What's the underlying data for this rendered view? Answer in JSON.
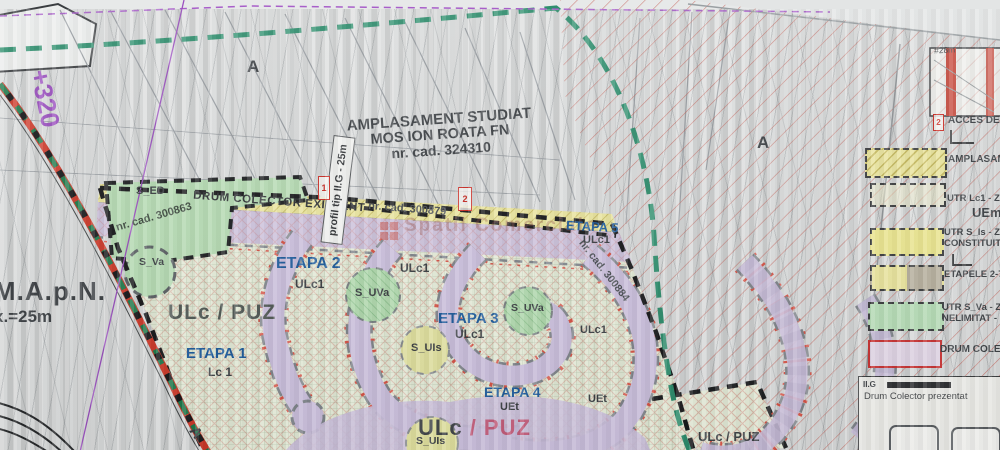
{
  "map": {
    "region_labels": {
      "a1": "A",
      "a2": "A",
      "a3": "A"
    },
    "annotations": {
      "plus320": "+320",
      "mapn": "M.A.p.N.",
      "mapn_width": "x.=25m",
      "amplasament_line1": "AMPLASAMENT STUDIAT",
      "amplasament_line2": "MOS ION ROATA FN",
      "amplasament_line3": "nr. cad. 324310",
      "drum_colector": "DRUM COLECTOR EXISTENT",
      "profil": "profil tip II.G - 25m",
      "cad_300863": "nr. cad. 300863",
      "cad_300879": "nr. cad. 300879",
      "cad_300884": "nr. cad. 300884",
      "mini_width": "#28m",
      "watermark": "Spatii Comerciale"
    },
    "stages": {
      "etapa1": "ETAPA 1",
      "etapa1_zone": "Lc 1",
      "etapa2": "ETAPA 2",
      "etapa2_zone": "ULc1",
      "etapa3": "ETAPA 3",
      "etapa3_zone": "ULc1",
      "etapa4": "ETAPA 4",
      "etapa4_zone": "UEt",
      "etapa5": "ETAPA 5",
      "etapa5_zone": "ULc1",
      "uet_extra": "UEt",
      "ulc1_extra_a": "ULc1",
      "ulc1_extra_b": "ULc1",
      "ulc_puz_main": "ULc / PUZ",
      "ulc_puz_bottom_dark": "ULc",
      "ulc_puz_bottom_pink": "/ PUZ",
      "ulc_puz_east": "ULc / PUZ"
    },
    "zones": {
      "s_ed": "S_ED",
      "s_va": "S_Va",
      "s_uva_1": "S_UVa",
      "s_uva_2": "S_UVa",
      "s_uis_1": "S_UIs",
      "s_uis_2": "S_UIs"
    },
    "markers": {
      "profile_1": "1",
      "profile_2": "2"
    }
  },
  "legend": {
    "access_marker": "2",
    "access": "ACCES DE",
    "amplasament": "AMPLASAM",
    "utr_lc1": "UTR Lc1 - Z",
    "uem": "UEm",
    "utr_s_is": "UTR S_Is - Z",
    "constituit": "CONSTITUIT",
    "etapele": "ETAPELE 2-7",
    "utr_s_va": "UTR S_Va - Z",
    "nelimitat": "NELIMITAT - R",
    "drum_colector": "DRUM COLEC",
    "profile_box_tag": "II.G",
    "profile_box_title": "Drum Colector prezentat"
  },
  "colors": {
    "boundary_black": "#1c1e20",
    "stage_blue": "#1d5c9e",
    "teal_dash": "#2e8f6e",
    "road_red": "#d0392b",
    "easement_purple": "#9b4fc0",
    "road_lavender": "#cdc1df",
    "band_yellow": "#ece79e",
    "zone_green": "#b7ddb4",
    "hatch_red": "#cc5a50"
  }
}
